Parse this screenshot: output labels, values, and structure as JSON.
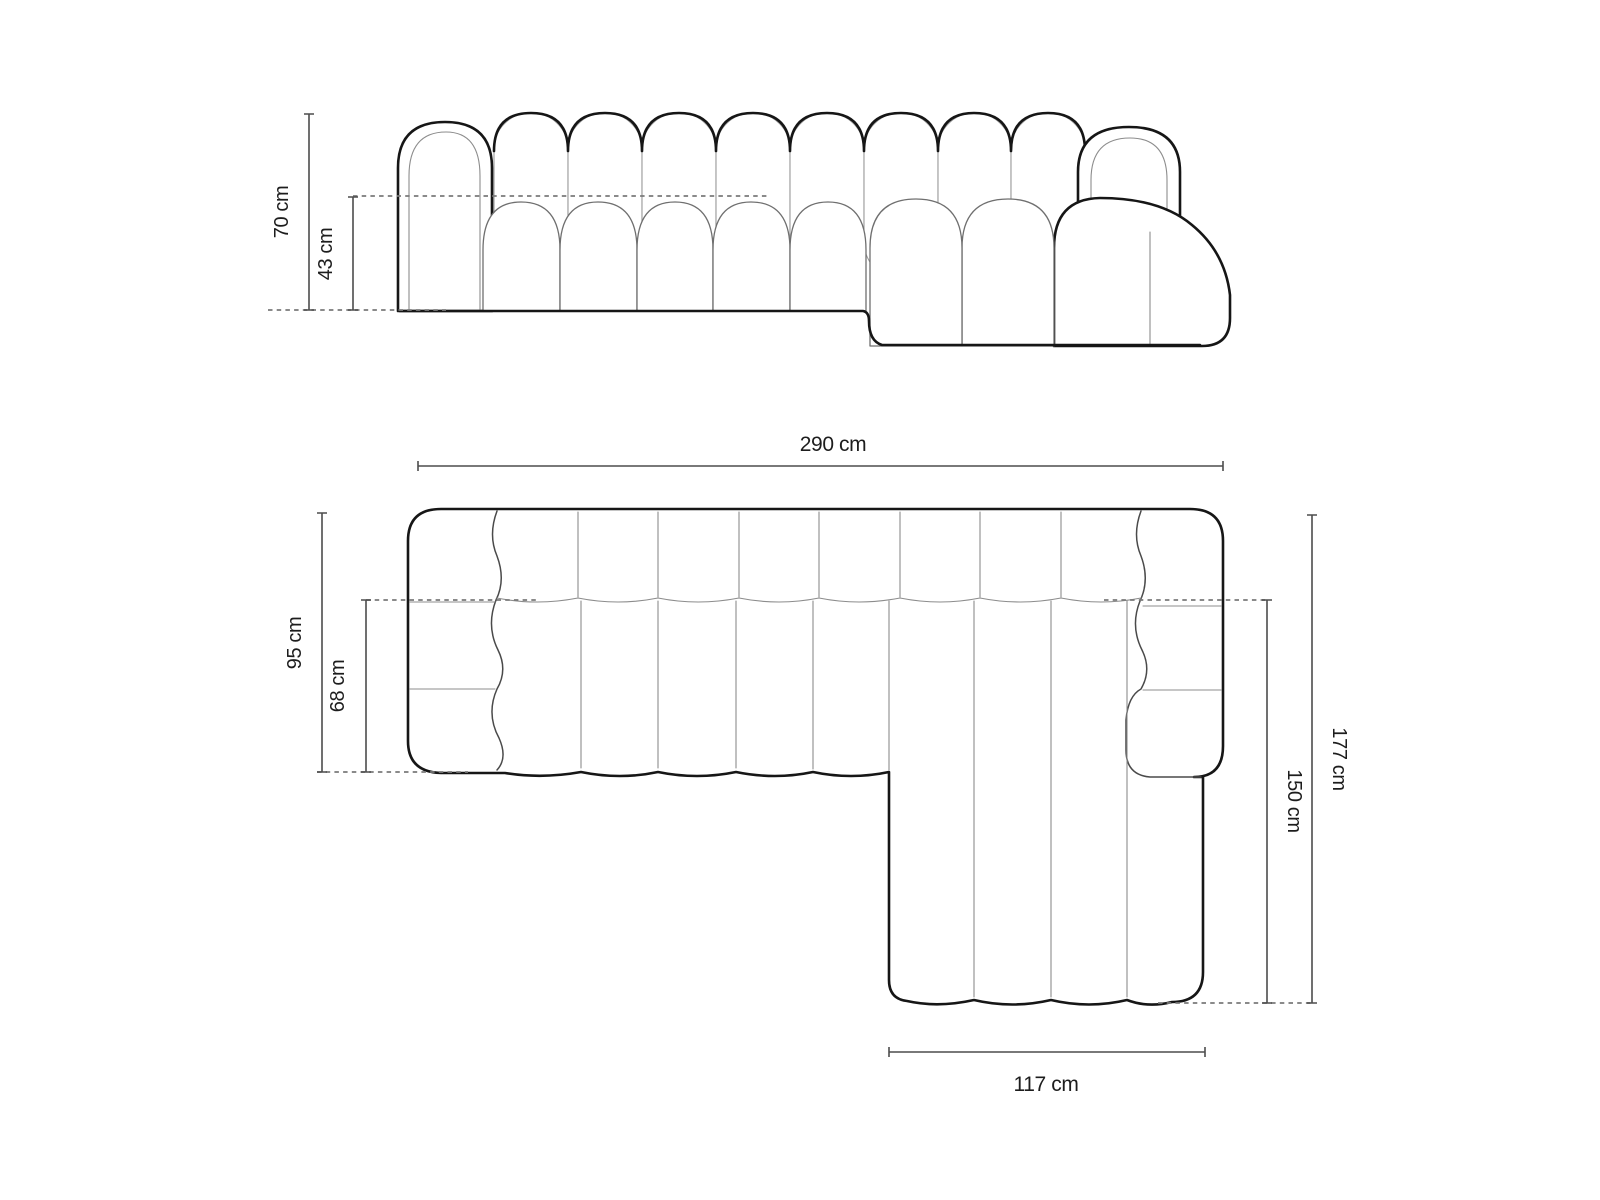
{
  "figure": {
    "kind": "sofa-dimension-diagram",
    "background": "#ffffff",
    "colors": {
      "ink": "#161616",
      "thin_line": "#8c8c8c",
      "dimension_line": "#4d4d4d",
      "label": "#1d1d1d"
    }
  },
  "views": {
    "front": {
      "name": "front-elevation",
      "dims": {
        "total_height": {
          "label": "70 cm",
          "value": 70,
          "unit": "cm"
        },
        "seat_height": {
          "label": "43 cm",
          "value": 43,
          "unit": "cm"
        }
      }
    },
    "top": {
      "name": "top-plan",
      "dims": {
        "total_width": {
          "label": "290 cm",
          "value": 290,
          "unit": "cm"
        },
        "body_depth": {
          "label": "95 cm",
          "value": 95,
          "unit": "cm"
        },
        "seat_depth": {
          "label": "68 cm",
          "value": 68,
          "unit": "cm"
        },
        "total_depth": {
          "label": "177 cm",
          "value": 177,
          "unit": "cm"
        },
        "chaise_depth": {
          "label": "150 cm",
          "value": 150,
          "unit": "cm"
        },
        "chaise_width": {
          "label": "117 cm",
          "value": 117,
          "unit": "cm"
        }
      }
    }
  }
}
